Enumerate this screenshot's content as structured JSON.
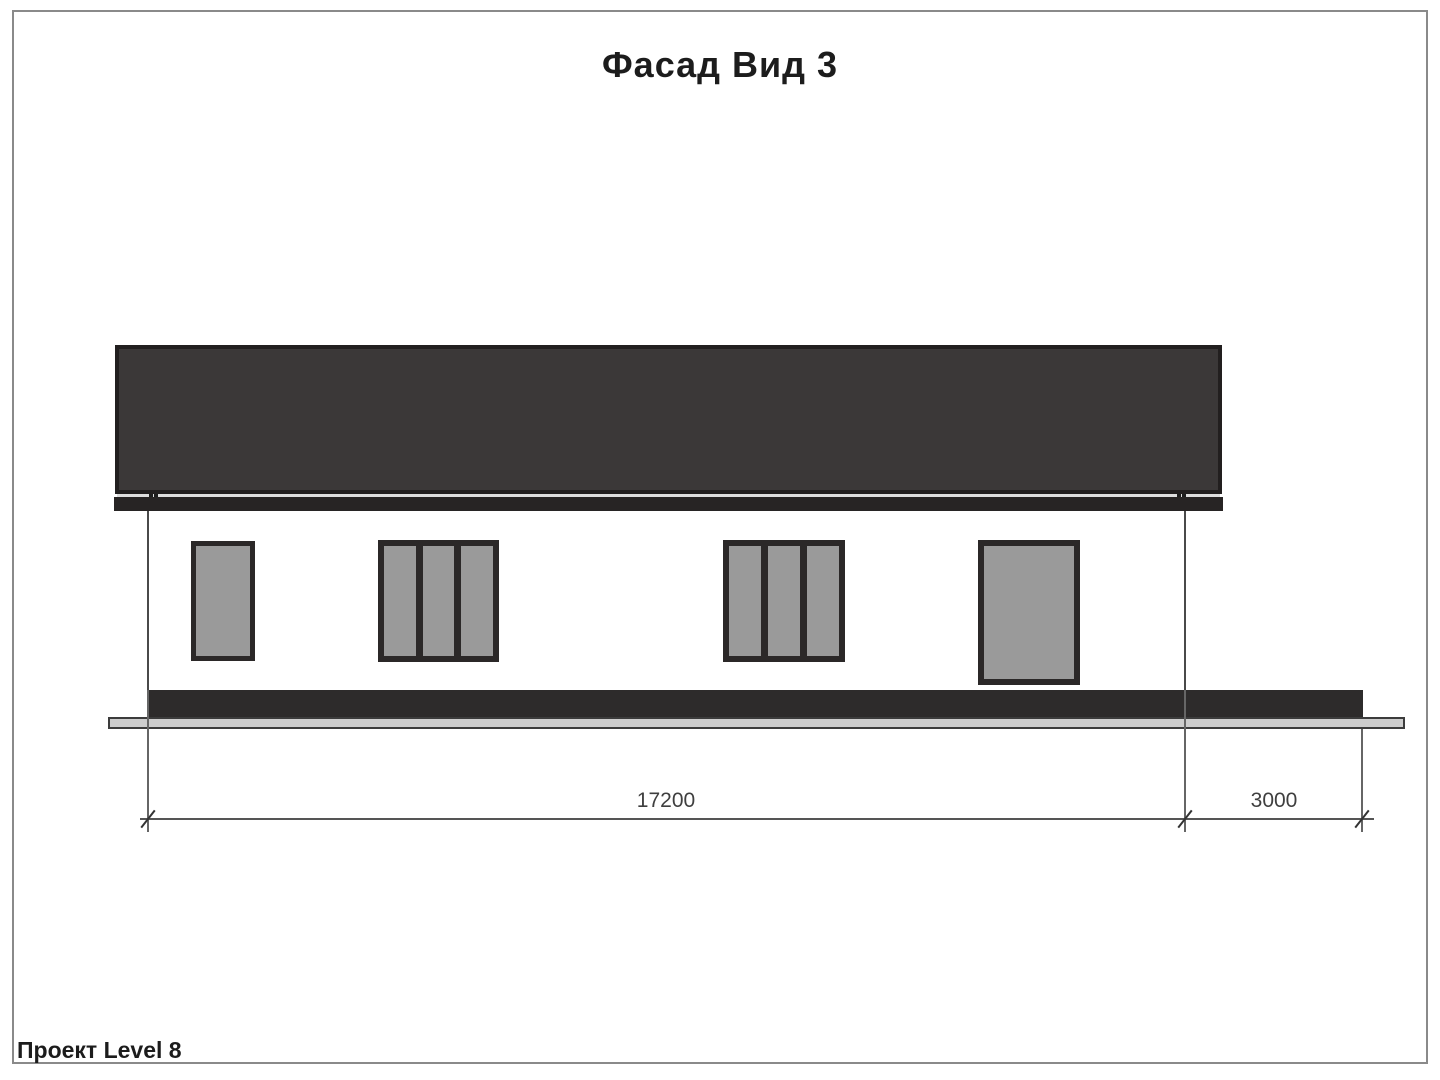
{
  "page": {
    "title": "Фасад Вид 3",
    "footer": "Проект Level 8"
  },
  "drawing": {
    "type": "facade-elevation",
    "view_number": "3",
    "dimensions": {
      "building_width_mm": "17200",
      "terrace_width_mm": "3000"
    },
    "window_count": 4,
    "colors": {
      "roof": "#3b3838",
      "fascia": "#272424",
      "window-frame": "#2b2828",
      "glass": "#9a9a9a",
      "plinth": "#2d2b2b",
      "ground": "#cdcdcd",
      "dim-line": "#555555",
      "text": "#1c1c1c",
      "frame-border": "#8a8a8a"
    }
  }
}
